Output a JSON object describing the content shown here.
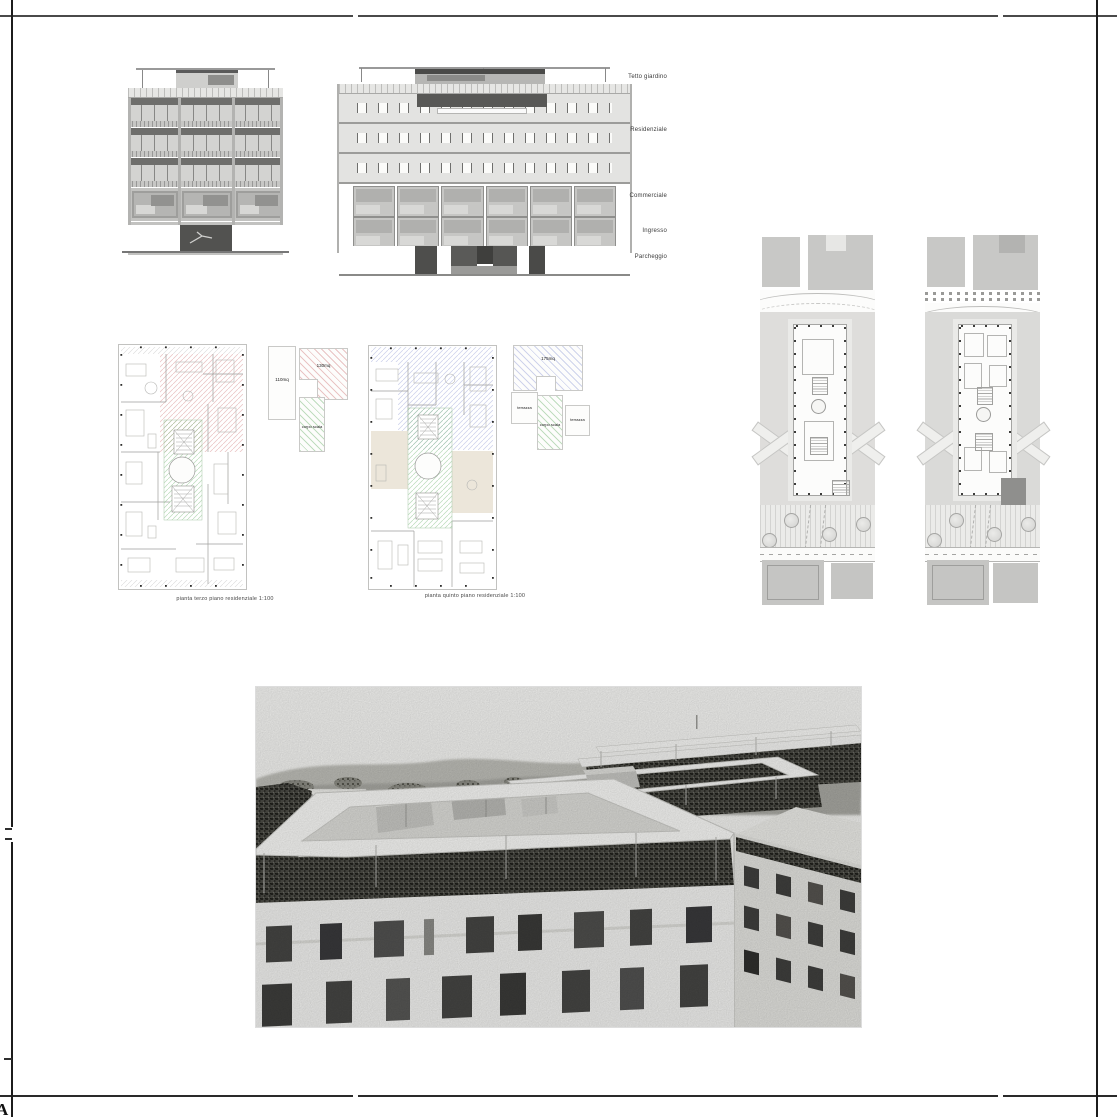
{
  "sheet": {
    "marker": "A"
  },
  "section_labels": {
    "items": [
      {
        "label": "Tetto giardino"
      },
      {
        "label": "Residenziale"
      },
      {
        "label": "Commerciale"
      },
      {
        "label": "Ingresso"
      },
      {
        "label": "Parcheggio"
      }
    ]
  },
  "plans": {
    "plan_left": {
      "caption": "pianta terzo piano residenziale 1:100",
      "key_area_1": "110mq",
      "key_area_2": "130mq",
      "key_core": "corpo scala"
    },
    "plan_right": {
      "caption": "pianta quinto piano residenziale 1:100",
      "key_area": "175mq",
      "key_terrace_1": "terrazza",
      "key_core": "corpo scala",
      "key_terrace_2": "terrazza"
    }
  },
  "colors": {
    "pink_hatch": "#d68c8c",
    "green_hatch": "#8cc38c",
    "blue_hatch": "#96a0d7",
    "site_gray": "#dedddb",
    "frame_line": "#4a4a4a"
  }
}
